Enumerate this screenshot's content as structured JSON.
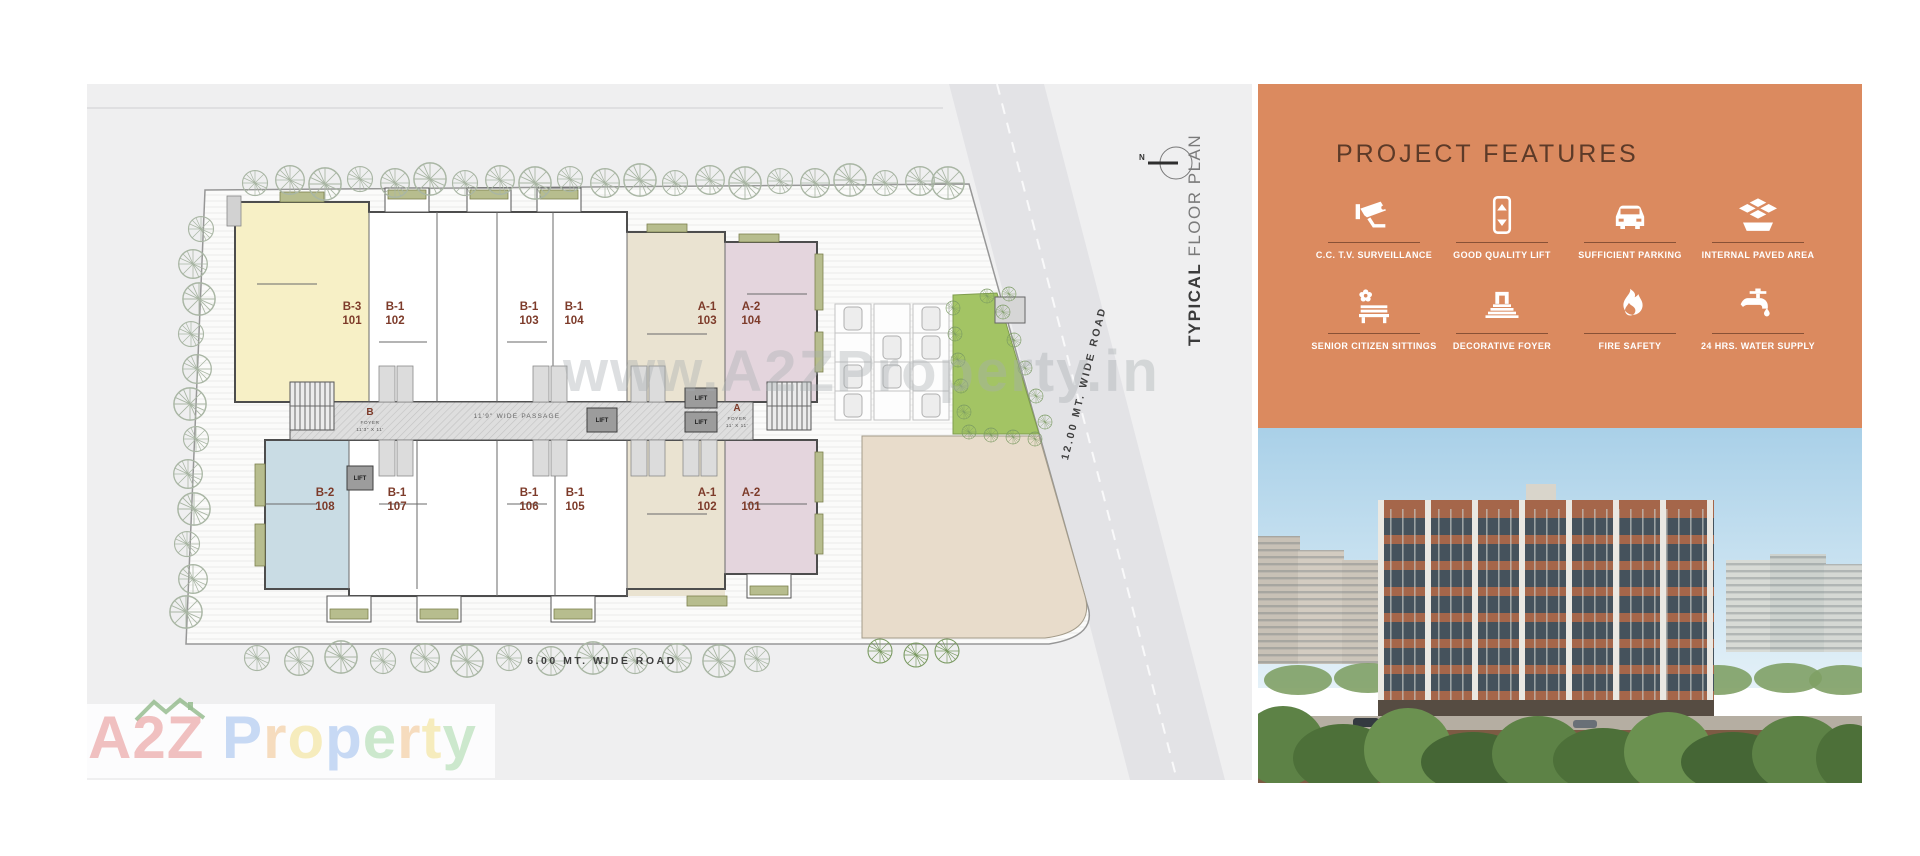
{
  "plan": {
    "title_bold": "TYPICAL",
    "title_light": " FLOOR PLAN",
    "compass": "N",
    "road_right": "12.00 MT. WIDE ROAD",
    "road_bottom": "6.00 MT. WIDE ROAD",
    "passage": "11'9\" WIDE PASSAGE",
    "lift": "LIFT",
    "foyers": [
      {
        "letter": "B",
        "label": "FOYER",
        "size": "11'3\" X 11'"
      },
      {
        "letter": "A",
        "label": "FOYER",
        "size": "11' X 11'"
      }
    ],
    "units": [
      {
        "name": "B-3",
        "num": "101",
        "color": "#f7f0c6"
      },
      {
        "name": "B-1",
        "num": "102",
        "color": "#ffffff"
      },
      {
        "name": "B-1",
        "num": "103",
        "color": "#ffffff"
      },
      {
        "name": "B-1",
        "num": "104",
        "color": "#ffffff"
      },
      {
        "name": "A-1",
        "num": "103",
        "color": "#eae3d1"
      },
      {
        "name": "A-2",
        "num": "104",
        "color": "#e4d5dd"
      },
      {
        "name": "B-2",
        "num": "108",
        "color": "#c9dce4"
      },
      {
        "name": "B-1",
        "num": "107",
        "color": "#ffffff"
      },
      {
        "name": "B-1",
        "num": "106",
        "color": "#ffffff"
      },
      {
        "name": "B-1",
        "num": "105",
        "color": "#ffffff"
      },
      {
        "name": "A-1",
        "num": "102",
        "color": "#eae3d1"
      },
      {
        "name": "A-2",
        "num": "101",
        "color": "#e4d5dd"
      }
    ]
  },
  "watermark": {
    "url": "www.A2ZProperty.in",
    "logo_letters": [
      {
        "ch": "A",
        "color": "#e89090"
      },
      {
        "ch": "2",
        "color": "#e89090"
      },
      {
        "ch": "Z",
        "color": "#e89090"
      },
      {
        "ch": " ",
        "color": "#ffffff"
      },
      {
        "ch": "P",
        "color": "#9cbdee"
      },
      {
        "ch": "r",
        "color": "#f2c28c"
      },
      {
        "ch": "o",
        "color": "#f2df8a"
      },
      {
        "ch": "p",
        "color": "#9cbdee"
      },
      {
        "ch": "e",
        "color": "#a6d8a6"
      },
      {
        "ch": "r",
        "color": "#f2c28c"
      },
      {
        "ch": "t",
        "color": "#f2df8a"
      },
      {
        "ch": "y",
        "color": "#a6d8a6"
      }
    ]
  },
  "features": {
    "title": "PROJECT FEATURES",
    "panel_color": "#db8a5f",
    "items": [
      {
        "label": "C.C. T.V. SURVEILLANCE",
        "icon": "cctv-icon"
      },
      {
        "label": "GOOD QUALITY LIFT",
        "icon": "lift-icon"
      },
      {
        "label": "SUFFICIENT PARKING",
        "icon": "car-icon"
      },
      {
        "label": "INTERNAL PAVED AREA",
        "icon": "paving-icon"
      },
      {
        "label": "SENIOR CITIZEN SITTINGS",
        "icon": "bench-icon"
      },
      {
        "label": "DECORATIVE FOYER",
        "icon": "foyer-icon"
      },
      {
        "label": "FIRE SAFETY",
        "icon": "flame-icon"
      },
      {
        "label": "24 HRS. WATER SUPPLY",
        "icon": "tap-icon"
      }
    ]
  }
}
